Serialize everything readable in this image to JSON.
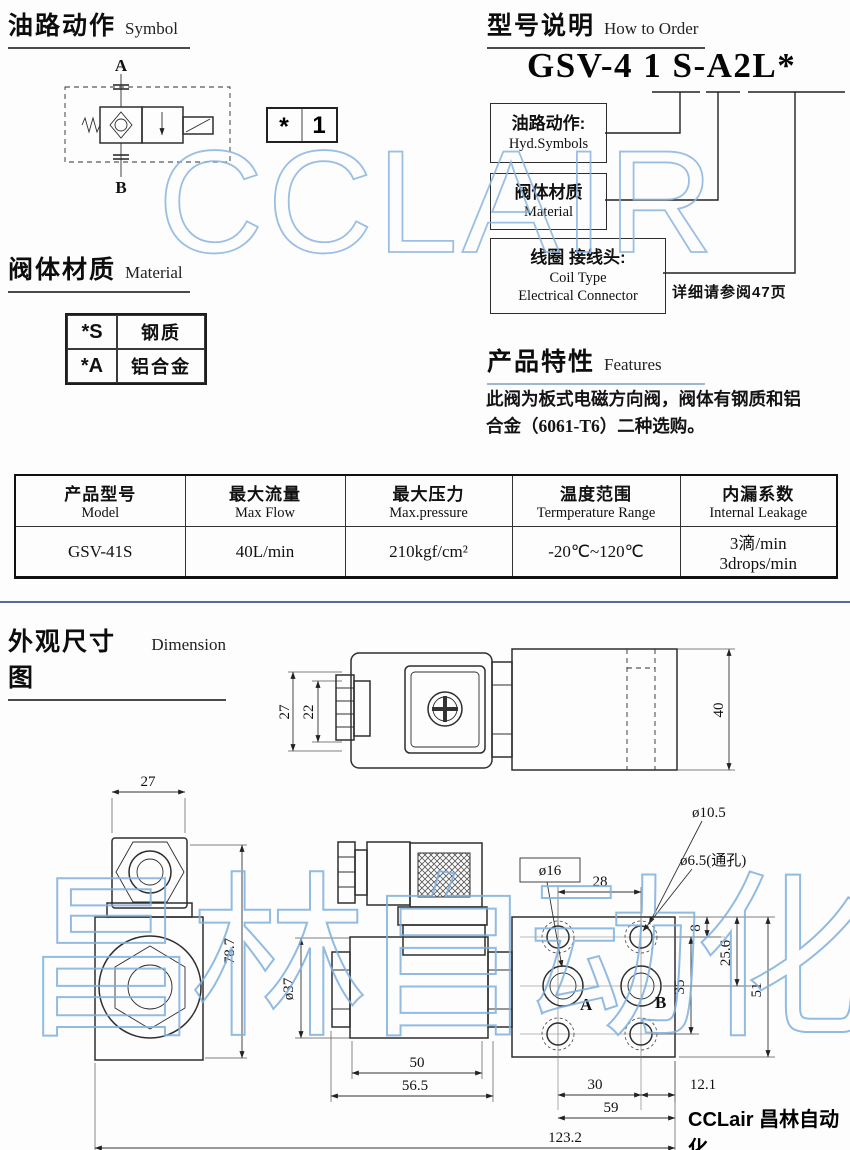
{
  "watermark": {
    "top": "CCLAIR",
    "bottom": "昌林自动化"
  },
  "symbol": {
    "title_zh": "油路动作",
    "title_en": "Symbol",
    "port_a": "A",
    "port_b": "B",
    "box_star": "*",
    "box_num": "1"
  },
  "order": {
    "title_zh": "型号说明",
    "title_en": "How to Order",
    "model_code": "GSV-4 1 S-A2L*",
    "box1_zh": "油路动作:",
    "box1_en": "Hyd.Symbols",
    "box2_zh": "阀体材质",
    "box2_en": "Material",
    "box3_zh": "线圈 接线头:",
    "box3_en": "Coil Type",
    "box3_en2": "Electrical Connector",
    "note": "详细请参阅47页"
  },
  "material": {
    "title_zh": "阀体材质",
    "title_en": "Material",
    "rows": [
      {
        "code": "*S",
        "name": "钢质"
      },
      {
        "code": "*A",
        "name": "铝合金"
      }
    ]
  },
  "features": {
    "title_zh": "产品特性",
    "title_en": "Features",
    "line1": "此阀为板式电磁方向阀，阀体有钢质和铝",
    "line2": "合金（6061-T6）二种选购。"
  },
  "spec": {
    "headers": [
      {
        "zh": "产品型号",
        "en": "Model"
      },
      {
        "zh": "最大流量",
        "en": "Max Flow"
      },
      {
        "zh": "最大压力",
        "en": "Max.pressure"
      },
      {
        "zh": "温度范围",
        "en": "Termperature Range"
      },
      {
        "zh": "内漏系数",
        "en": "Internal Leakage"
      }
    ],
    "row": {
      "model": "GSV-41S",
      "flow": "40L/min",
      "pressure": "210kgf/cm²",
      "temp": "-20℃~120℃",
      "leak_zh": "3滴/min",
      "leak_en": "3drops/min"
    }
  },
  "dimension": {
    "title_zh": "外观尺寸图",
    "title_en": "Dimension",
    "dims": {
      "top_27": "27",
      "top_22": "22",
      "top_40": "40",
      "left_27": "27",
      "left_78_7": "78.7",
      "coil_dia": "ø37",
      "len_50": "50",
      "len_56_5": "56.5",
      "len_123_2": "123.2",
      "port_dia": "ø16",
      "hole_span_28": "28",
      "cbore_10_5": "ø10.5",
      "thru_6_5": "ø6.5(通孔)",
      "edge_8": "8",
      "edge_25_6": "25.6",
      "span_35": "35",
      "height_51": "51",
      "span_30": "30",
      "edge_12_1": "12.1",
      "width_59": "59",
      "port_a": "A",
      "port_b": "B"
    }
  },
  "footer": {
    "logo": "CCLair 昌林自动化"
  }
}
